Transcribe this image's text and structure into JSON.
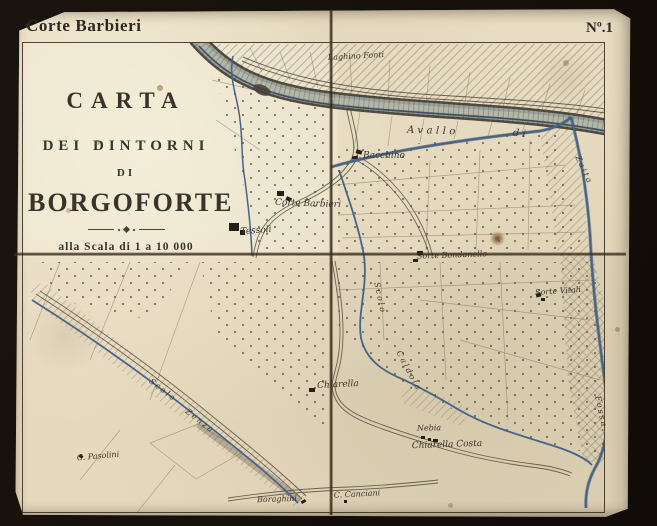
{
  "header": {
    "left_title": "Corte Barbieri",
    "sheet_number": "Nº.1"
  },
  "title_block": {
    "line1": "CARTA",
    "line2": "DEI DINTORNI",
    "line3": "DI",
    "line4": "BORGOFORTE",
    "scale": "alla Scala di 1 a 10 000"
  },
  "colors": {
    "paper": "#e7dcc2",
    "ink": "#39322a",
    "water": "#46648a",
    "background": "#17110d",
    "fold_line": "#3e2e1e"
  },
  "map": {
    "labels": [
      {
        "text": "Laghino Fonti",
        "x": 356,
        "y": 56,
        "rot": -3,
        "cls": "tiny"
      },
      {
        "text": "Avallo",
        "x": 433,
        "y": 131,
        "rot": 2,
        "cls": "spaced"
      },
      {
        "text": "di",
        "x": 521,
        "y": 134,
        "rot": 5,
        "cls": "spaced"
      },
      {
        "text": "Bacchino",
        "x": 384,
        "y": 156,
        "rot": 0,
        "cls": "small"
      },
      {
        "text": "Corte Barbieri",
        "x": 308,
        "y": 204,
        "rot": 2,
        "cls": "small"
      },
      {
        "text": "Tessoli",
        "x": 256,
        "y": 231,
        "rot": -4,
        "cls": "small"
      },
      {
        "text": "Sorte Bondanello",
        "x": 452,
        "y": 255,
        "rot": -2,
        "cls": "tiny"
      },
      {
        "text": "Sorte Vitali",
        "x": 558,
        "y": 291,
        "rot": -4,
        "cls": "tiny"
      },
      {
        "text": "Scolo",
        "x": 380,
        "y": 298,
        "rot": 78,
        "cls": "water-label"
      },
      {
        "text": "Caldola",
        "x": 409,
        "y": 371,
        "rot": 62,
        "cls": "water-label"
      },
      {
        "text": "Zaita",
        "x": 584,
        "y": 170,
        "rot": 65,
        "cls": "water-label"
      },
      {
        "text": "Fossa",
        "x": 601,
        "y": 412,
        "rot": 78,
        "cls": "water-label"
      },
      {
        "text": "Chiarella",
        "x": 338,
        "y": 385,
        "rot": -3,
        "cls": "small"
      },
      {
        "text": "Nebia",
        "x": 429,
        "y": 428,
        "rot": -2,
        "cls": "tiny"
      },
      {
        "text": "Chiarella Costa",
        "x": 447,
        "y": 445,
        "rot": -2,
        "cls": "small"
      },
      {
        "text": "C. Pasolini",
        "x": 98,
        "y": 456,
        "rot": -5,
        "cls": "tiny"
      },
      {
        "text": "Boraghini",
        "x": 277,
        "y": 499,
        "rot": -2,
        "cls": "tiny"
      },
      {
        "text": "C. Canciani",
        "x": 357,
        "y": 494,
        "rot": -3,
        "cls": "tiny"
      },
      {
        "text": "Scolo",
        "x": 163,
        "y": 390,
        "rot": 38,
        "cls": "water-label"
      },
      {
        "text": "Zenza",
        "x": 200,
        "y": 421,
        "rot": 38,
        "cls": "water-label"
      }
    ],
    "buildings": [
      {
        "x": 356,
        "y": 150,
        "w": 6,
        "h": 4,
        "rot": 15
      },
      {
        "x": 352,
        "y": 156,
        "w": 6,
        "h": 3,
        "rot": -10
      },
      {
        "x": 277,
        "y": 191,
        "w": 7,
        "h": 5,
        "rot": 0
      },
      {
        "x": 286,
        "y": 197,
        "w": 5,
        "h": 4,
        "rot": 25
      },
      {
        "x": 229,
        "y": 223,
        "w": 10,
        "h": 8,
        "rot": 0
      },
      {
        "x": 240,
        "y": 230,
        "w": 5,
        "h": 5,
        "rot": 0
      },
      {
        "x": 417,
        "y": 251,
        "w": 6,
        "h": 4,
        "rot": 0
      },
      {
        "x": 413,
        "y": 259,
        "w": 5,
        "h": 3,
        "rot": 0
      },
      {
        "x": 536,
        "y": 293,
        "w": 5,
        "h": 4,
        "rot": -15
      },
      {
        "x": 541,
        "y": 298,
        "w": 4,
        "h": 3,
        "rot": 0
      },
      {
        "x": 309,
        "y": 388,
        "w": 6,
        "h": 4,
        "rot": 0
      },
      {
        "x": 421,
        "y": 436,
        "w": 4,
        "h": 3,
        "rot": 0
      },
      {
        "x": 428,
        "y": 438,
        "w": 3,
        "h": 3,
        "rot": 0
      },
      {
        "x": 433,
        "y": 439,
        "w": 5,
        "h": 3,
        "rot": 0
      },
      {
        "x": 344,
        "y": 500,
        "w": 3,
        "h": 3,
        "rot": 0
      },
      {
        "x": 301,
        "y": 500,
        "w": 5,
        "h": 3,
        "rot": -30
      },
      {
        "x": 79,
        "y": 455,
        "w": 4,
        "h": 3,
        "rot": 40
      }
    ]
  }
}
